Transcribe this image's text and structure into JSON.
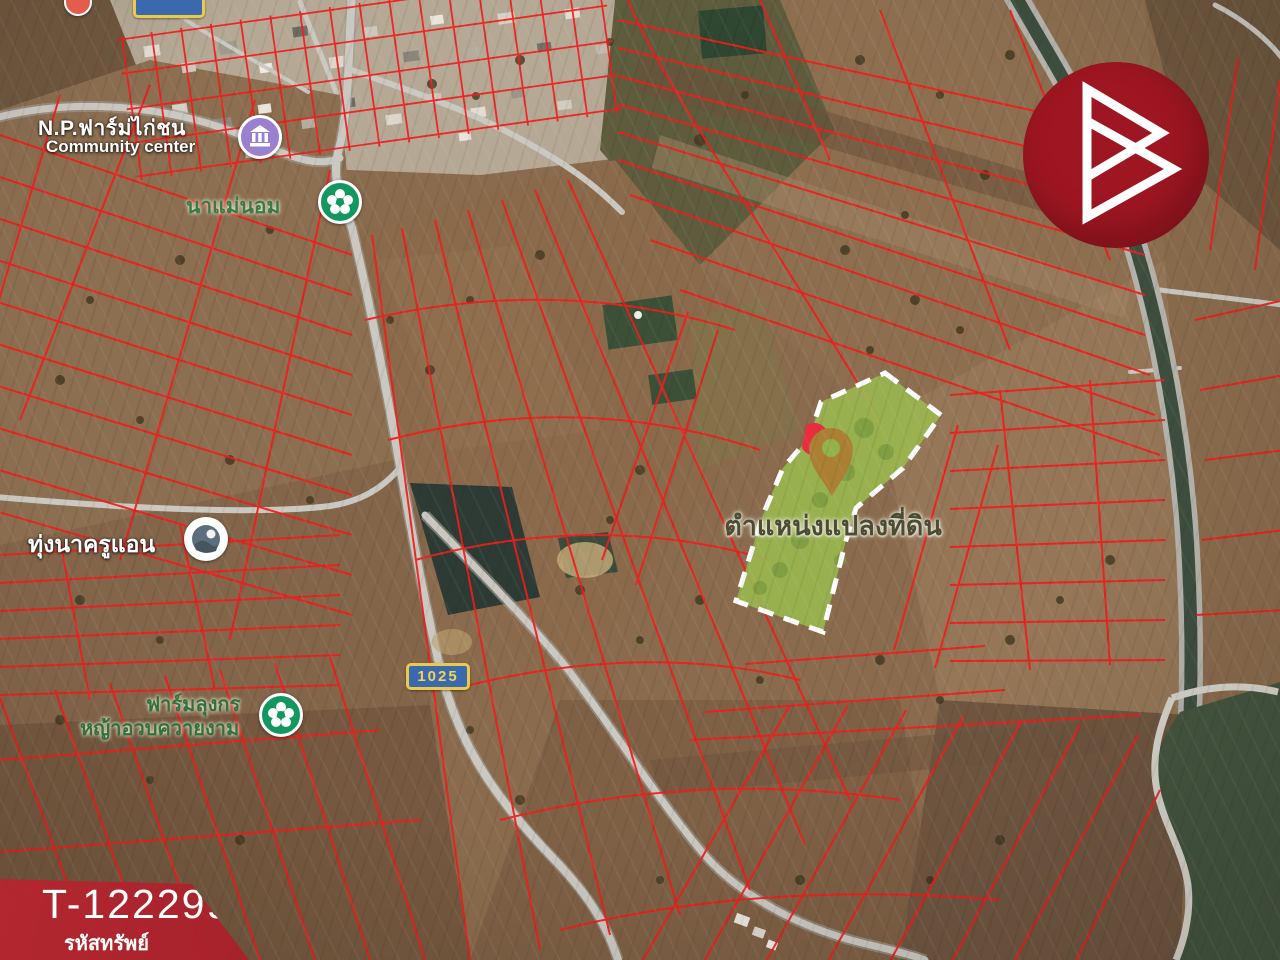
{
  "property": {
    "code": "T-122299",
    "code_label": "รหัสทรัพย์"
  },
  "map": {
    "type": "satellite-with-cadastral-overlay",
    "poi": {
      "community_center": {
        "name": "N.P.ฟาร์ม่ไก่ชน",
        "category": "Community center"
      },
      "na_mae_nom": {
        "name": "นาแม่นอม"
      },
      "thung_na_khru_aen": {
        "name": "ทุ่งนาครูแอน"
      },
      "farm_lung_korn": {
        "name": "ฟาร์มลุงกร",
        "subtitle": "หญ้าอวบควายงาม"
      }
    },
    "parcel": {
      "label": "ตำแหน่งแปลงที่ดิน"
    },
    "route_badge": {
      "number": "1025"
    },
    "colors": {
      "cadastral_line": "#f11d1d",
      "parcel_fill": "#9aba4f",
      "parcel_border": "#ffffff",
      "pin": "#ab8034",
      "banner_red": "#b2222e",
      "logo_red": "#9e1621",
      "badge_blue": "#3b69ae",
      "badge_yellow": "#e8ca4d"
    }
  }
}
